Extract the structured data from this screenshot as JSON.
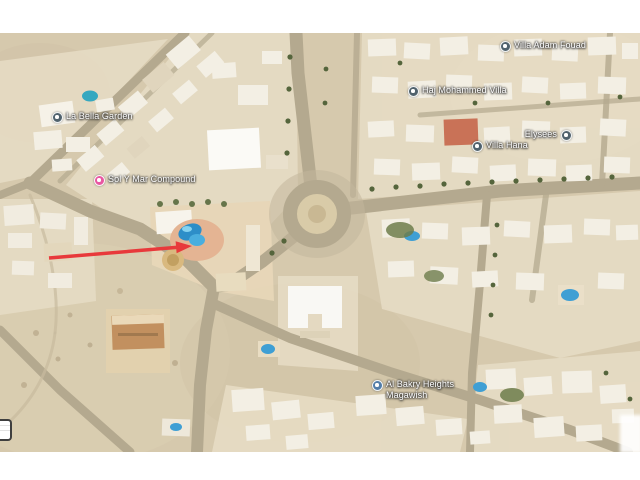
{
  "map": {
    "kind": "satellite-map",
    "colors": {
      "sand": "#d6c9ad",
      "road": "#b4a98f",
      "building": "#f3efe4",
      "pool": "#3f9fd4",
      "default_marker": "#50626d",
      "lodging_marker": "#e857a1",
      "heights_marker": "#527da8",
      "arrow": "#e8393b"
    },
    "markers": [
      {
        "name": "la-bella-garden",
        "lines": [
          "La Bella Garden"
        ],
        "x": 57,
        "y": 84,
        "color": "#50626d",
        "text_side": "right"
      },
      {
        "name": "sol-y-mar-compound",
        "lines": [
          "Sol Y Mar Compound"
        ],
        "x": 99,
        "y": 147,
        "color": "#e857a1",
        "text_side": "right"
      },
      {
        "name": "haj-mohammed-villa",
        "lines": [
          "Haj Mohammed Villa"
        ],
        "x": 413,
        "y": 58,
        "color": "#50626d",
        "text_side": "right"
      },
      {
        "name": "villa-adam-fouad",
        "lines": [
          "Villa Adam Fouad"
        ],
        "x": 505,
        "y": 13,
        "color": "#50626d",
        "text_side": "right"
      },
      {
        "name": "elysees",
        "lines": [
          "Elysees"
        ],
        "x": 566,
        "y": 102,
        "color": "#50626d",
        "text_side": "left"
      },
      {
        "name": "villa-hana",
        "lines": [
          "Villa Hana"
        ],
        "x": 477,
        "y": 113,
        "color": "#50626d",
        "text_side": "right"
      },
      {
        "name": "al-bakry-heights-magawish",
        "lines": [
          "Al Bakry Heights",
          "Magawish"
        ],
        "x": 377,
        "y": 352,
        "color": "#527da8",
        "text_side": "right"
      }
    ],
    "annotation_arrow": {
      "color": "#e8393b"
    }
  }
}
